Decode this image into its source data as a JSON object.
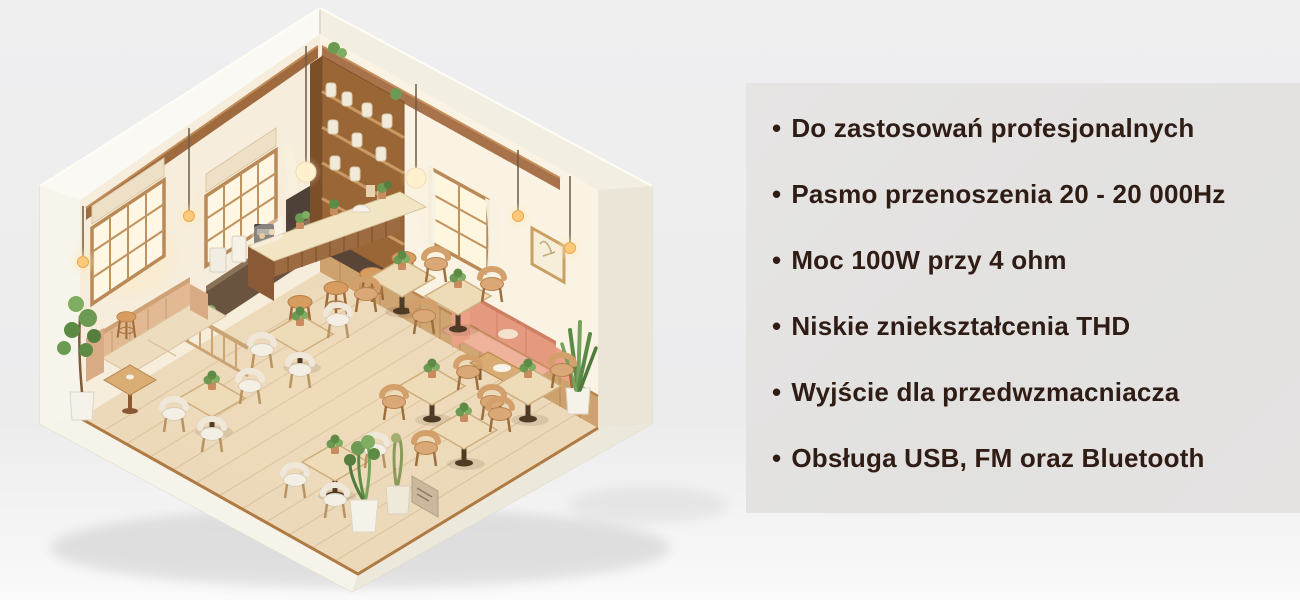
{
  "features_panel": {
    "background": "#e3e2e1",
    "text_color": "#2f1d15",
    "bullet": "•",
    "items": [
      "Do zastosowań profesjonalnych",
      "Pasmo przenoszenia 20 - 20 000Hz",
      "Moc 100W przy 4 ohm",
      "Niskie zniekształcenia THD",
      "Wyjście dla przedwzmacniacza",
      "Obsługa USB, FM oraz Bluetooth"
    ]
  },
  "illustration": {
    "name": "isometric-cafe-interior-cutaway",
    "description": "Izometryczna makieta wnętrza kawiarni: bar z hokerami, regał, stoliki z krzesłami, sofy, rośliny, świecące okna i lampy",
    "palette": {
      "exterior_wall": "#f5f1e7",
      "interior_wall_left": "#f6eddc",
      "interior_wall_right": "#faf3e4",
      "floor_wood": "#ecd9ba",
      "wood_dark": "#9c6b42",
      "wood_mid": "#c9995e",
      "table_top": "#eedcb8",
      "chair_white": "#f4efe4",
      "chair_tan": "#d9a876",
      "sofa_beige": "#e2b992",
      "sofa_pink": "#e59a80",
      "plant_green": "#6d9a52",
      "window_glow": "#ffe9bd",
      "bulb": "#ffc97c"
    }
  }
}
